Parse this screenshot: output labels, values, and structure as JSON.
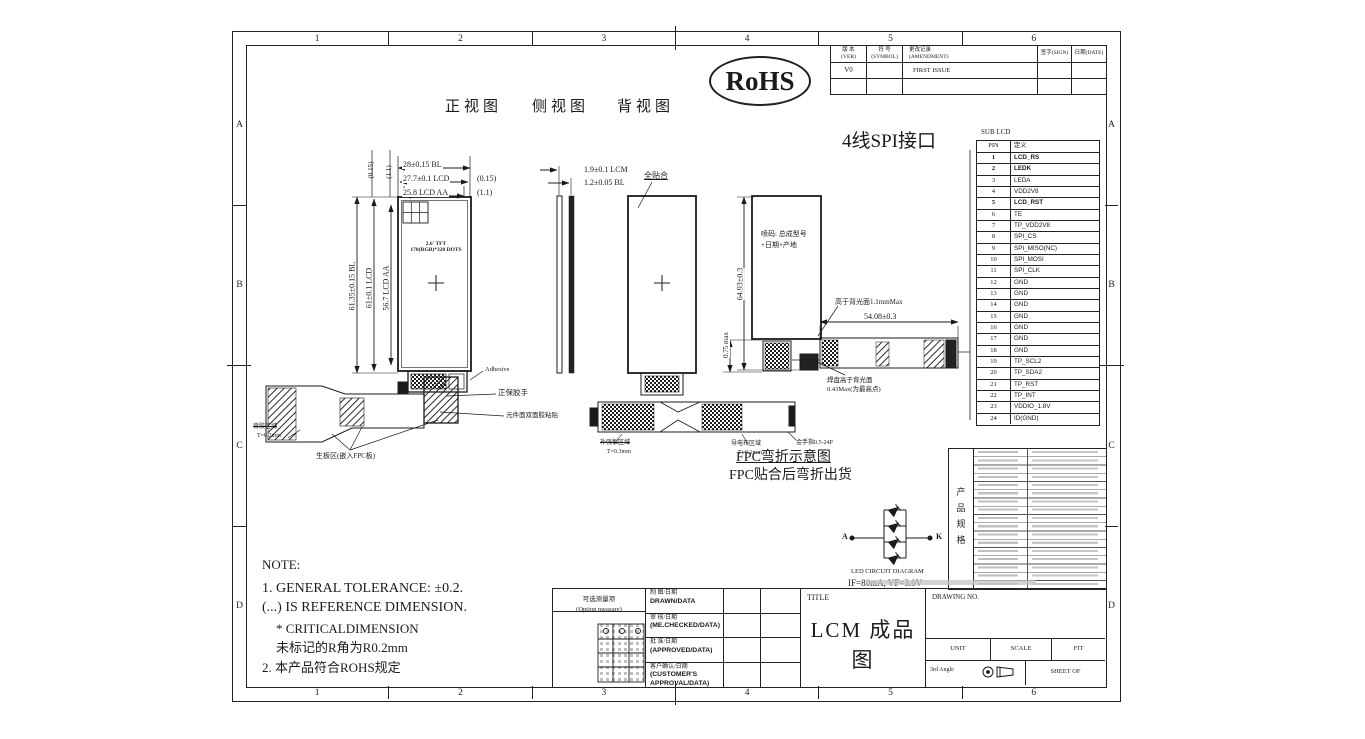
{
  "frame": {
    "cols": [
      "1",
      "2",
      "3",
      "4",
      "5",
      "6"
    ],
    "rows": [
      "A",
      "B",
      "C",
      "D"
    ]
  },
  "badge": {
    "rohs": "RoHS"
  },
  "view_titles": {
    "front": "正视图",
    "side": "侧视图",
    "back": "背视图"
  },
  "revision": {
    "h_ver_cn": "版 本",
    "h_ver_en": "(VER)",
    "h_sym_cn": "符 号",
    "h_sym_en": "(SYMBOL)",
    "h_amd_cn": "更改记录",
    "h_amd_en": "(AMENDMENT)",
    "h_sign": "签字(SIGN)",
    "h_date": "日期(DATE)",
    "row_ver": "V0",
    "row_amendment": "FIRST ISSUE"
  },
  "interface": {
    "title": "4线SPI接口",
    "caption": "SUB LCD",
    "col_pin": "PIN",
    "col_def": "定义",
    "pins": [
      {
        "no": "1",
        "name": "LCD_RS",
        "bold": true
      },
      {
        "no": "2",
        "name": "LEDK",
        "bold": true
      },
      {
        "no": "3",
        "name": "LEDA"
      },
      {
        "no": "4",
        "name": "VDD2V8"
      },
      {
        "no": "5",
        "name": "LCD_RST",
        "bold": true
      },
      {
        "no": "6",
        "name": "TE"
      },
      {
        "no": "7",
        "name": "TP_VDD2V8"
      },
      {
        "no": "8",
        "name": "SPI_CS"
      },
      {
        "no": "9",
        "name": "SPI_MISO(NC)"
      },
      {
        "no": "10",
        "name": "SPI_MOSI"
      },
      {
        "no": "11",
        "name": "SPI_CLK"
      },
      {
        "no": "12",
        "name": "GND"
      },
      {
        "no": "13",
        "name": "GND"
      },
      {
        "no": "14",
        "name": "GND"
      },
      {
        "no": "15",
        "name": "GND"
      },
      {
        "no": "16",
        "name": "GND"
      },
      {
        "no": "17",
        "name": "GND"
      },
      {
        "no": "18",
        "name": "GND"
      },
      {
        "no": "19",
        "name": "TP_SCL2"
      },
      {
        "no": "20",
        "name": "TP_SDA2"
      },
      {
        "no": "21",
        "name": "TP_RST"
      },
      {
        "no": "22",
        "name": "TP_INT"
      },
      {
        "no": "23",
        "name": "VDDIO_1.8V"
      },
      {
        "no": "24",
        "name": "ID(GND)"
      }
    ]
  },
  "dims": {
    "front_top_1": "28±0.15 BL",
    "front_top_2": "27.7±0.1 LCD",
    "front_top_2_ref": "(0.15)",
    "front_top_3": "25.8 LCD AA",
    "front_top_3_ref": "(1.1)",
    "front_gap_ref_1": "(0.15)",
    "front_gap_ref_2": "(1.1)",
    "front_left_1": "61.35±0.15 BL",
    "front_left_2": "61±0.1 LCD",
    "front_left_3": "56.7 LCD AA",
    "side_1": "1.9±0.1 LCM",
    "side_2": "1.2±0.05 BL",
    "fpc_length": "54.08±0.3",
    "total_height": "64.93±0.3",
    "pad_height": "0.75 max"
  },
  "annotations": {
    "panel_line1": "2.6' TFT",
    "panel_line2": "170(RGB)*320 DOTS",
    "adhesive": "Adhesive",
    "front_tab": "正保胶手",
    "component_tape": "元件面双面胶粘贴",
    "peel_area": "背胶区域",
    "peel_thk": "T=0.2mm",
    "steel_area": "生板区(嵌入FPC板)",
    "full_lamination": "全贴合",
    "spray_line1": "喷码: 总成型号",
    "spray_line2": "+日期+产地",
    "above_backlight": "高于背光面1.1mmMax",
    "pad_above_1": "焊盘高于背光面",
    "pad_above_2": "0.43Max(为最高点)",
    "stiffener": "补强板区域",
    "stiffener_thk": "T=0.3mm",
    "conductive": "导电布区域",
    "conductive_thk": "T=0.1mm",
    "goldfinger": "金手指0.5-24P"
  },
  "fpc_bend": {
    "title": "FPC弯折示意图",
    "subtitle": "FPC贴合后弯折出货"
  },
  "led": {
    "a": "A",
    "k": "K",
    "caption": "LED CIRCUIT DIAGRAM",
    "spec": "IF=80mA, VF=3.0V"
  },
  "spec_table": {
    "side_label": "产品规格"
  },
  "note": {
    "heading": "NOTE:",
    "line1": "1. GENERAL TOLERANCE: ±0.2.",
    "line2": "(...) IS REFERENCE DIMENSION.",
    "line3": "* CRITICALDIMENSION",
    "line4": "未标记的R角为R0.2mm",
    "line5": "2. 本产品符合ROHS规定"
  },
  "title_block": {
    "option_cn": "可选测量项",
    "option_en": "(Option measure)",
    "sign_rows": [
      {
        "cn": "制 图/日期",
        "en": "DRAWN/DATA"
      },
      {
        "cn": "审 核/日期",
        "en": "(ME.CHECKED/DATA)"
      },
      {
        "cn": "批 准/日期",
        "en": "(APPROVED/DATA)"
      },
      {
        "cn": "客户确认/日期",
        "en": "(CUSTOMER'S APPROVAL/DATA)"
      }
    ],
    "title_label": "TITLE",
    "title": "LCM 成品图",
    "drawing_no_label": "DRAWING NO.",
    "unit_label": "UNIT",
    "scale_label": "SCALE",
    "rev_label": "FIT",
    "angle_label": "3rd Angle",
    "sheet_label": "SHEET OF"
  }
}
